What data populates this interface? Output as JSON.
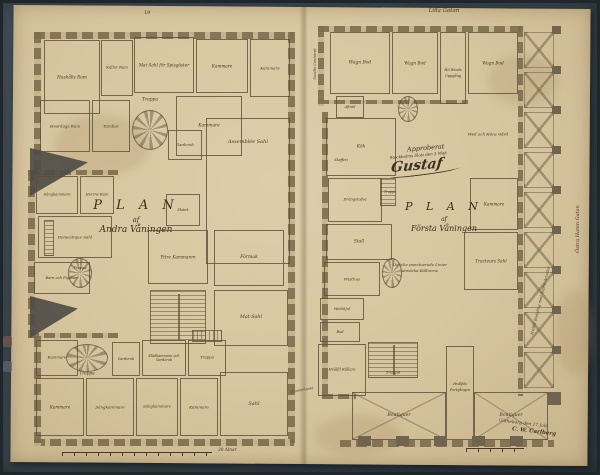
{
  "document": {
    "kind": "Scanned hand-drawn architectural floor plans on aged paper in dark mat",
    "lot_number": "19",
    "scale_label": "30 Alnar",
    "streets": {
      "top": "Lilla Gatan",
      "right": "Östra Hamn Gatan",
      "left_annotation": "Sundts Contoiret",
      "bottom_left_annotation": "Grannehuset"
    },
    "approval": {
      "line1": "Approberat",
      "line2": "Stockholms Slott den 3 Maji",
      "signature": "Gustaf"
    },
    "corner_inscription": {
      "line1": "Götheborg den 17 Julii",
      "line2": "C. W. Carlberg"
    },
    "arcade_note": "Hvälfd Bodgång med öppna Arcader",
    "colors": {
      "mat": "#3b4851",
      "paper": "#d7c59f",
      "ink": "#473821",
      "wall": "#7d6c4d"
    }
  },
  "left_plan": {
    "title_word": "P L A N",
    "title_af": "af",
    "title_floor": "Andra Våningen",
    "walls": [
      {
        "x": 34,
        "y": 32,
        "w": 260,
        "h": 7,
        "o": "h"
      },
      {
        "x": 288,
        "y": 32,
        "w": 7,
        "h": 414,
        "o": "v"
      },
      {
        "x": 34,
        "y": 439,
        "w": 260,
        "h": 7,
        "o": "h"
      },
      {
        "x": 34,
        "y": 32,
        "w": 7,
        "h": 140,
        "o": "v"
      },
      {
        "x": 28,
        "y": 170,
        "w": 7,
        "h": 168,
        "o": "v"
      },
      {
        "x": 28,
        "y": 170,
        "w": 90,
        "h": 5,
        "o": "h"
      },
      {
        "x": 28,
        "y": 333,
        "w": 90,
        "h": 5,
        "o": "h"
      },
      {
        "x": 34,
        "y": 336,
        "w": 7,
        "h": 110,
        "o": "v"
      }
    ],
    "rooms": [
      {
        "x": 44,
        "y": 40,
        "w": 56,
        "h": 74,
        "label": "Hushålls Rum",
        "fs": 4.2
      },
      {
        "x": 101,
        "y": 40,
        "w": 32,
        "h": 56,
        "label": "Källar Rum",
        "fs": 3.8
      },
      {
        "x": 134,
        "y": 37,
        "w": 60,
        "h": 56,
        "label": "Mat Sahl för Spisgäster",
        "fs": 4.2
      },
      {
        "x": 196,
        "y": 39,
        "w": 52,
        "h": 54,
        "label": "Kammare",
        "fs": 4.2
      },
      {
        "x": 250,
        "y": 39,
        "w": 40,
        "h": 58,
        "label": "Kammare",
        "fs": 4
      },
      {
        "x": 40,
        "y": 100,
        "w": 50,
        "h": 52,
        "label": "Hvardags Rum",
        "fs": 4
      },
      {
        "x": 92,
        "y": 100,
        "w": 38,
        "h": 52,
        "label": "Tambur",
        "fs": 4
      },
      {
        "x": 176,
        "y": 96,
        "w": 66,
        "h": 60,
        "label": "Kammare",
        "fs": 4.4
      },
      {
        "x": 206,
        "y": 118,
        "w": 84,
        "h": 146,
        "label": "Assemblée Sahl",
        "fs": 5,
        "pos": "top"
      },
      {
        "x": 168,
        "y": 130,
        "w": 34,
        "h": 30,
        "label": "Garderob",
        "fs": 3.6
      },
      {
        "x": 166,
        "y": 194,
        "w": 34,
        "h": 32,
        "label": "Skänk",
        "fs": 3.6
      },
      {
        "x": 36,
        "y": 176,
        "w": 42,
        "h": 38,
        "label": "Sängkammare",
        "fs": 3.7
      },
      {
        "x": 80,
        "y": 176,
        "w": 34,
        "h": 38,
        "label": "Herrns Rum",
        "fs": 3.7
      },
      {
        "x": 38,
        "y": 216,
        "w": 74,
        "h": 42,
        "label": "Domestique Sahl",
        "fs": 4
      },
      {
        "x": 34,
        "y": 262,
        "w": 56,
        "h": 32,
        "label": "Barn och Pig Rum",
        "fs": 3.6
      },
      {
        "x": 148,
        "y": 230,
        "w": 60,
        "h": 54,
        "label": "Yttre Kammaren",
        "fs": 4.2
      },
      {
        "x": 214,
        "y": 230,
        "w": 70,
        "h": 56,
        "label": "Förmak",
        "fs": 4.6
      },
      {
        "x": 214,
        "y": 290,
        "w": 74,
        "h": 56,
        "label": "Mat-Sahl",
        "fs": 4.8
      },
      {
        "x": 36,
        "y": 340,
        "w": 42,
        "h": 36,
        "label": "Kammare",
        "fs": 3.8
      },
      {
        "x": 112,
        "y": 342,
        "w": 28,
        "h": 34,
        "label": "Garderob",
        "fs": 3.4
      },
      {
        "x": 142,
        "y": 340,
        "w": 44,
        "h": 36,
        "label": "Klädkammare och Garderob",
        "fs": 3.4
      },
      {
        "x": 188,
        "y": 340,
        "w": 38,
        "h": 36,
        "label": "Trappa",
        "fs": 3.8
      },
      {
        "x": 36,
        "y": 378,
        "w": 48,
        "h": 58,
        "label": "Kammare",
        "fs": 4.2
      },
      {
        "x": 86,
        "y": 378,
        "w": 48,
        "h": 58,
        "label": "Sängkammare",
        "fs": 4
      },
      {
        "x": 136,
        "y": 378,
        "w": 42,
        "h": 58,
        "label": "Sängkammare",
        "fs": 3.8
      },
      {
        "x": 180,
        "y": 378,
        "w": 38,
        "h": 58,
        "label": "Kammare",
        "fs": 4
      },
      {
        "x": 220,
        "y": 372,
        "w": 68,
        "h": 64,
        "label": "Sahl",
        "fs": 5
      }
    ],
    "stairs": [
      {
        "x": 132,
        "y": 110,
        "w": 36,
        "h": 40,
        "type": "spiral"
      },
      {
        "x": 44,
        "y": 220,
        "w": 10,
        "h": 36,
        "type": "sv"
      },
      {
        "x": 68,
        "y": 258,
        "w": 24,
        "h": 30,
        "type": "spiral"
      },
      {
        "x": 150,
        "y": 290,
        "w": 56,
        "h": 54,
        "type": "double"
      },
      {
        "x": 66,
        "y": 344,
        "w": 42,
        "h": 28,
        "type": "spiral"
      },
      {
        "x": 192,
        "y": 330,
        "w": 30,
        "h": 12,
        "type": "sh"
      }
    ],
    "roofs": [
      {
        "x": 30,
        "y": 148,
        "w": 58,
        "h": 48
      },
      {
        "x": 30,
        "y": 296,
        "w": 48,
        "h": 42
      }
    ],
    "free_labels": [
      {
        "x": 150,
        "y": 100,
        "text": "Trappa",
        "s": 4.4
      },
      {
        "x": 80,
        "y": 268,
        "text": "Trappa",
        "s": 3.6
      },
      {
        "x": 87,
        "y": 373,
        "text": "Trappa",
        "s": 4.2
      }
    ]
  },
  "right_plan": {
    "title_word": "P L A N",
    "title_af": "af",
    "title_floor": "Första Våningen",
    "note_line1": "De icke punctuerade Linier",
    "note_line2": "utmärka Källrarne",
    "walls": [
      {
        "x": 318,
        "y": 26,
        "w": 206,
        "h": 6,
        "o": "h"
      },
      {
        "x": 318,
        "y": 26,
        "w": 6,
        "h": 80,
        "o": "v"
      },
      {
        "x": 318,
        "y": 100,
        "w": 150,
        "h": 4,
        "o": "h"
      },
      {
        "x": 322,
        "y": 112,
        "w": 6,
        "h": 286,
        "o": "v"
      },
      {
        "x": 322,
        "y": 394,
        "w": 34,
        "h": 5,
        "o": "h"
      },
      {
        "x": 340,
        "y": 440,
        "w": 214,
        "h": 7,
        "o": "h"
      },
      {
        "x": 518,
        "y": 26,
        "w": 5,
        "h": 370,
        "o": "v"
      }
    ],
    "rooms": [
      {
        "x": 330,
        "y": 32,
        "w": 60,
        "h": 62,
        "label": "Wagn Bod",
        "fs": 4.4
      },
      {
        "x": 392,
        "y": 32,
        "w": 46,
        "h": 62,
        "label": "Wagn Bod",
        "fs": 4.2
      },
      {
        "x": 440,
        "y": 32,
        "w": 26,
        "h": 72,
        "label": "",
        "fs": 3.5
      },
      {
        "x": 468,
        "y": 32,
        "w": 50,
        "h": 62,
        "label": "Wagn Bod",
        "fs": 4.2
      },
      {
        "x": 336,
        "y": 96,
        "w": 28,
        "h": 22,
        "label": "Afträd",
        "fs": 3.4
      },
      {
        "x": 326,
        "y": 118,
        "w": 70,
        "h": 58,
        "label": "Kök",
        "fs": 4.4
      },
      {
        "x": 328,
        "y": 178,
        "w": 54,
        "h": 44,
        "label": "Drängstufva",
        "fs": 3.7
      },
      {
        "x": 326,
        "y": 224,
        "w": 66,
        "h": 36,
        "label": "Stall",
        "fs": 4.4
      },
      {
        "x": 324,
        "y": 262,
        "w": 56,
        "h": 34,
        "label": "Wisthus",
        "fs": 4
      },
      {
        "x": 320,
        "y": 298,
        "w": 44,
        "h": 22,
        "label": "Wedskjul",
        "fs": 3.5
      },
      {
        "x": 320,
        "y": 322,
        "w": 40,
        "h": 20,
        "label": "Bod",
        "fs": 3.6
      },
      {
        "x": 318,
        "y": 344,
        "w": 48,
        "h": 52,
        "label": "Hvälfd Källare",
        "fs": 3.7
      },
      {
        "x": 470,
        "y": 178,
        "w": 48,
        "h": 52,
        "label": "Kammare",
        "fs": 4.2
      },
      {
        "x": 464,
        "y": 232,
        "w": 54,
        "h": 58,
        "label": "Tracteurs Sahl",
        "fs": 4.2
      },
      {
        "x": 446,
        "y": 346,
        "w": 28,
        "h": 94,
        "label": "",
        "fs": 3.5
      },
      {
        "x": 352,
        "y": 392,
        "w": 94,
        "h": 48,
        "label": "Boutiquer",
        "fs": 4.6,
        "vault": true
      },
      {
        "x": 474,
        "y": 392,
        "w": 74,
        "h": 48,
        "label": "Boutiquer",
        "fs": 4.6,
        "vault": true
      }
    ],
    "stairs": [
      {
        "x": 398,
        "y": 96,
        "w": 20,
        "h": 26,
        "type": "spiral"
      },
      {
        "x": 380,
        "y": 178,
        "w": 16,
        "h": 28,
        "type": "sv"
      },
      {
        "x": 382,
        "y": 258,
        "w": 20,
        "h": 30,
        "type": "spiral"
      },
      {
        "x": 368,
        "y": 342,
        "w": 50,
        "h": 36,
        "type": "double"
      }
    ],
    "roofs": [],
    "free_labels": [
      {
        "x": 453,
        "y": 70,
        "text": "Hö Winds",
        "s": 3.5
      },
      {
        "x": 453,
        "y": 76,
        "text": "Uppgång",
        "s": 3.5
      },
      {
        "x": 341,
        "y": 160,
        "text": "Skafferi",
        "s": 3.4
      },
      {
        "x": 390,
        "y": 192,
        "text": "Trappa",
        "s": 3.3
      },
      {
        "x": 393,
        "y": 372,
        "text": "Trappa",
        "s": 4
      },
      {
        "x": 460,
        "y": 384,
        "text": "Hvälfda",
        "s": 3.4
      },
      {
        "x": 460,
        "y": 390,
        "text": "Portgången",
        "s": 3.4
      },
      {
        "x": 488,
        "y": 134,
        "text": "Wed och Höns Gård",
        "s": 4
      }
    ],
    "arcade": {
      "cells": [
        {
          "x": 524,
          "y": 32,
          "w": 28,
          "h": 34
        },
        {
          "x": 524,
          "y": 72,
          "w": 28,
          "h": 34
        },
        {
          "x": 524,
          "y": 112,
          "w": 28,
          "h": 34
        },
        {
          "x": 524,
          "y": 152,
          "w": 28,
          "h": 34
        },
        {
          "x": 524,
          "y": 192,
          "w": 28,
          "h": 34
        },
        {
          "x": 524,
          "y": 232,
          "w": 28,
          "h": 34
        },
        {
          "x": 524,
          "y": 272,
          "w": 28,
          "h": 34
        },
        {
          "x": 524,
          "y": 312,
          "w": 28,
          "h": 34
        },
        {
          "x": 524,
          "y": 352,
          "w": 28,
          "h": 34
        }
      ],
      "pillars": [
        {
          "x": 552,
          "y": 26,
          "w": 9,
          "h": 8
        },
        {
          "x": 552,
          "y": 66,
          "w": 9,
          "h": 8
        },
        {
          "x": 552,
          "y": 106,
          "w": 9,
          "h": 8
        },
        {
          "x": 552,
          "y": 146,
          "w": 9,
          "h": 8
        },
        {
          "x": 552,
          "y": 186,
          "w": 9,
          "h": 8
        },
        {
          "x": 552,
          "y": 226,
          "w": 9,
          "h": 8
        },
        {
          "x": 552,
          "y": 266,
          "w": 9,
          "h": 8
        },
        {
          "x": 552,
          "y": 306,
          "w": 9,
          "h": 8
        },
        {
          "x": 552,
          "y": 346,
          "w": 9,
          "h": 8
        },
        {
          "x": 548,
          "y": 392,
          "w": 13,
          "h": 13
        },
        {
          "x": 358,
          "y": 436,
          "w": 13,
          "h": 10
        },
        {
          "x": 396,
          "y": 436,
          "w": 13,
          "h": 10
        },
        {
          "x": 434,
          "y": 436,
          "w": 13,
          "h": 10
        },
        {
          "x": 472,
          "y": 436,
          "w": 13,
          "h": 10
        },
        {
          "x": 510,
          "y": 436,
          "w": 13,
          "h": 10
        }
      ]
    }
  }
}
